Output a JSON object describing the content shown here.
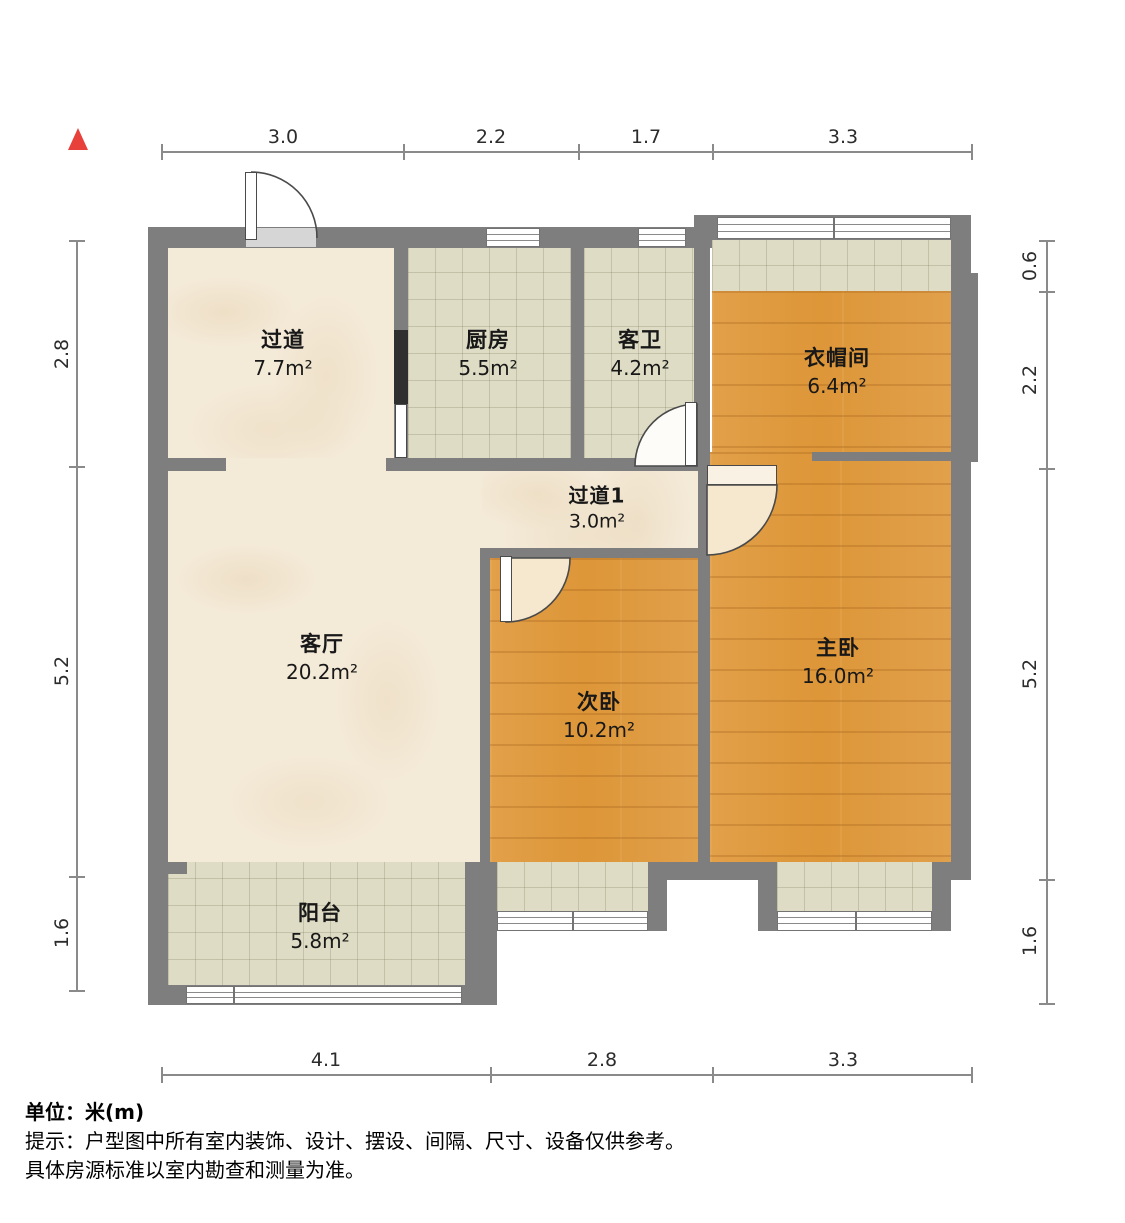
{
  "rooms": {
    "hallway": {
      "name": "过道",
      "area": "7.7m²"
    },
    "kitchen": {
      "name": "厨房",
      "area": "5.5m²"
    },
    "guest_bath": {
      "name": "客卫",
      "area": "4.2m²"
    },
    "cloakroom": {
      "name": "衣帽间",
      "area": "6.4m²"
    },
    "hallway1": {
      "name": "过道1",
      "area": "3.0m²"
    },
    "living_room": {
      "name": "客厅",
      "area": "20.2m²"
    },
    "second_bedroom": {
      "name": "次卧",
      "area": "10.2m²"
    },
    "master_bedroom": {
      "name": "主卧",
      "area": "16.0m²"
    },
    "balcony": {
      "name": "阳台",
      "area": "5.8m²"
    }
  },
  "dimensions": {
    "top": [
      {
        "label": "3.0"
      },
      {
        "label": "2.2"
      },
      {
        "label": "1.7"
      },
      {
        "label": "3.3"
      }
    ],
    "bottom": [
      {
        "label": "4.1"
      },
      {
        "label": "2.8"
      },
      {
        "label": "3.3"
      }
    ],
    "left": [
      {
        "label": "2.8"
      },
      {
        "label": "5.2"
      },
      {
        "label": "1.6"
      }
    ],
    "right": [
      {
        "label": "0.6"
      },
      {
        "label": "2.2"
      },
      {
        "label": "5.2"
      },
      {
        "label": "1.6"
      }
    ]
  },
  "notes": {
    "unit": "单位：米(m)",
    "tip": "提示：户型图中所有室内装饰、设计、摆设、间隔、尺寸、设备仅供参考。",
    "tip2": "具体房源标准以室内勘查和测量为准。"
  },
  "watermark": {
    "text": "小牛看房"
  },
  "colors": {
    "wall": "#7e7e7e",
    "wood": "#dd9638",
    "marble": "#f4ead8",
    "tile": "#dedcc4",
    "door_swing": "#f6e8cf",
    "north_marker": "#e8403a",
    "dim_line": "#8a8a8a"
  }
}
